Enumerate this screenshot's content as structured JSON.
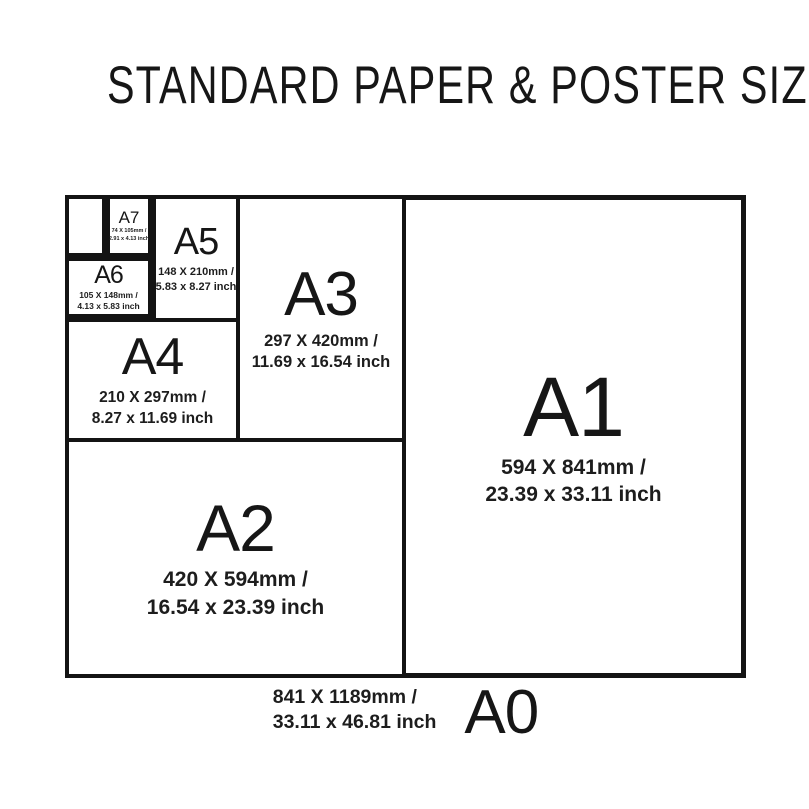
{
  "title": "STANDARD PAPER & POSTER SIZES",
  "sizes": {
    "a0": {
      "label": "A0",
      "mm": "841 X 1189mm /",
      "inch": "33.11 x 46.81 inch"
    },
    "a1": {
      "label": "A1",
      "mm": "594 X 841mm /",
      "inch": "23.39 x 33.11 inch"
    },
    "a2": {
      "label": "A2",
      "mm": "420 X 594mm /",
      "inch": "16.54 x 23.39 inch"
    },
    "a3": {
      "label": "A3",
      "mm": "297 X 420mm /",
      "inch": "11.69 x 16.54 inch"
    },
    "a4": {
      "label": "A4",
      "mm": "210 X 297mm /",
      "inch": "8.27 x 11.69 inch"
    },
    "a5": {
      "label": "A5",
      "mm": "148 X 210mm /",
      "inch": "5.83 x 8.27 inch"
    },
    "a6": {
      "label": "A6",
      "mm": "105 X 148mm /",
      "inch": "4.13 x 5.83 inch"
    },
    "a7": {
      "label": "A7",
      "mm": "74 X 105mm /",
      "inch": "2.91 x 4.13 inch"
    }
  },
  "colors": {
    "background": "#ffffff",
    "border": "#141414",
    "text": "#1a1a1a"
  }
}
